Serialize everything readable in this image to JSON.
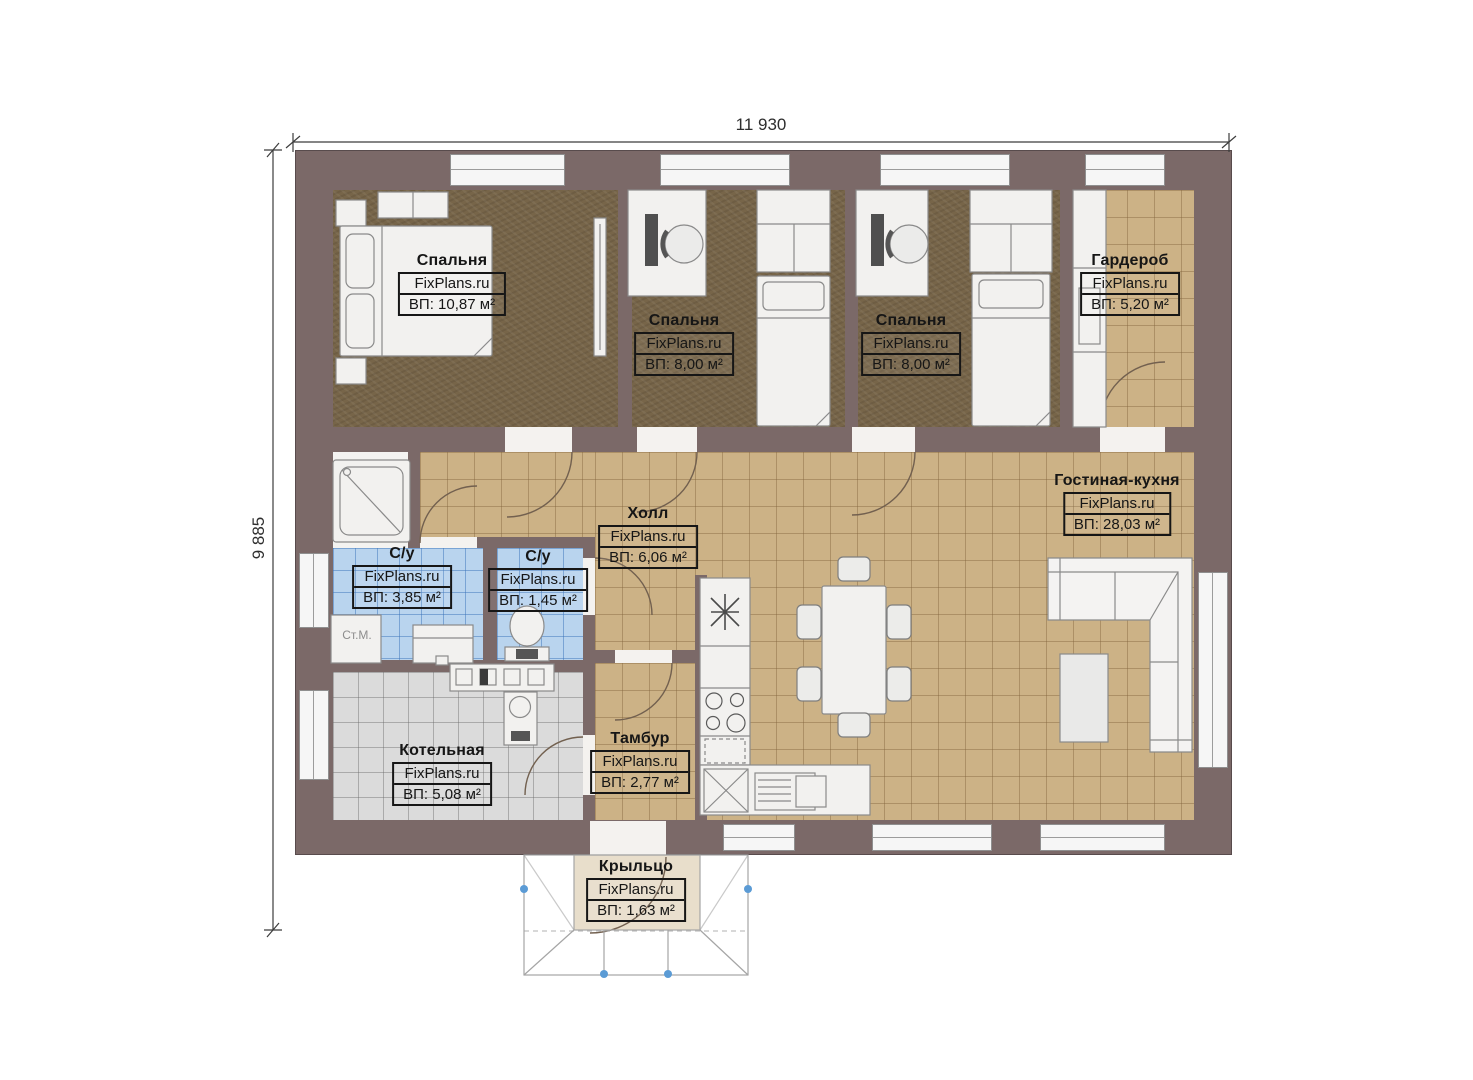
{
  "watermark": "FixPlans.ru",
  "dimensions": {
    "top": "11 930",
    "left": "9 885"
  },
  "rooms": [
    {
      "id": "bedroom-1",
      "name": "Спальня",
      "area": "ВП: 10,87 м²"
    },
    {
      "id": "bedroom-2",
      "name": "Спальня",
      "area": "ВП: 8,00 м²"
    },
    {
      "id": "bedroom-3",
      "name": "Спальня",
      "area": "ВП: 8,00 м²"
    },
    {
      "id": "wardrobe",
      "name": "Гардероб",
      "area": "ВП: 5,20 м²"
    },
    {
      "id": "hall",
      "name": "Холл",
      "area": "ВП: 6,06 м²"
    },
    {
      "id": "bathroom-1",
      "name": "С/у",
      "area": "ВП: 3,85 м²"
    },
    {
      "id": "bathroom-2",
      "name": "С/у",
      "area": "ВП: 1,45 м²"
    },
    {
      "id": "boiler-room",
      "name": "Котельная",
      "area": "ВП: 5,08 м²"
    },
    {
      "id": "vestibule",
      "name": "Тамбур",
      "area": "ВП: 2,77 м²"
    },
    {
      "id": "living-kitchen",
      "name": "Гостиная-кухня",
      "area": "ВП: 28,03 м²"
    },
    {
      "id": "porch",
      "name": "Крыльцо",
      "area": "ВП: 1,63 м²"
    }
  ],
  "annotations": {
    "washing_machine": "Ст.М."
  },
  "colors": {
    "wall": "#7b6968",
    "bedroom_floor": "#776549",
    "tile_tan": "#ccb286",
    "tile_blue": "#b9d4ee",
    "tile_gray": "#dbdbdb",
    "porch_floor": "#e8decb",
    "furniture": "#f2f1ef",
    "handle_blue": "#5b9bd5"
  }
}
